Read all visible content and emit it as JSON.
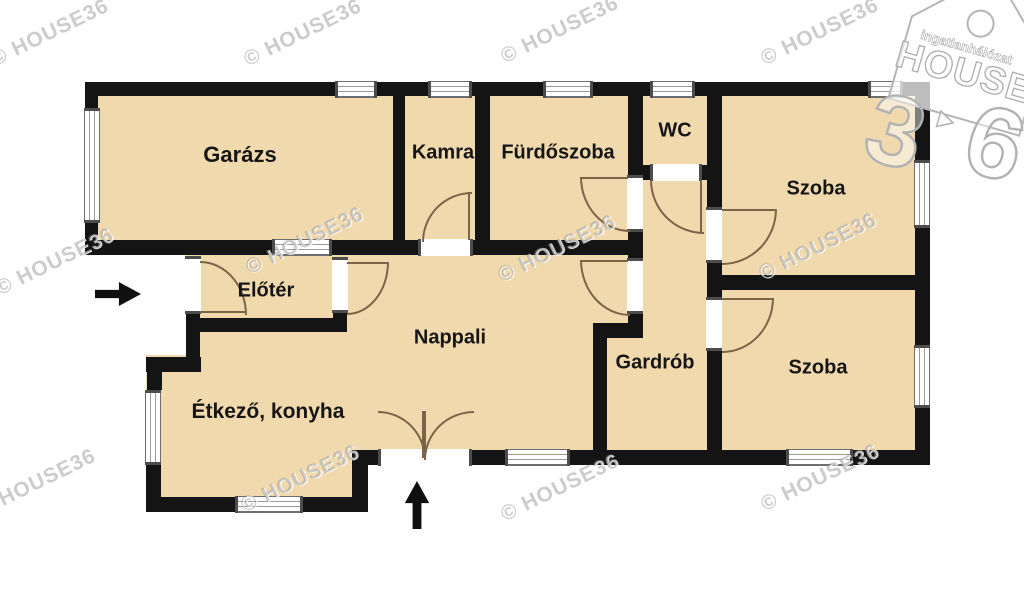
{
  "plan": {
    "type": "residential-floor-plan"
  },
  "rooms": {
    "garazs": {
      "label": "Garázs"
    },
    "kamra": {
      "label": "Kamra"
    },
    "furdoszoba": {
      "label": "Fürdőszoba"
    },
    "wc": {
      "label": "WC"
    },
    "szoba_felso": {
      "label": "Szoba"
    },
    "eloter": {
      "label": "Előtér"
    },
    "nappali": {
      "label": "Nappali"
    },
    "gardrob": {
      "label": "Gardrób"
    },
    "szoba_also": {
      "label": "Szoba"
    },
    "etkezo_konyha": {
      "label": "Étkező, konyha"
    }
  },
  "watermark": {
    "text": "© HOUSE36"
  },
  "logo": {
    "tagline": "ingatlanhálózat",
    "brand": "HOUSE",
    "digit_left": "3",
    "digit_right": "6"
  },
  "colors": {
    "floor": "#f1d9ae",
    "wall": "#141414",
    "door_arc": "#7a6548",
    "background": "#ffffff",
    "watermark_gray": "#868686"
  }
}
